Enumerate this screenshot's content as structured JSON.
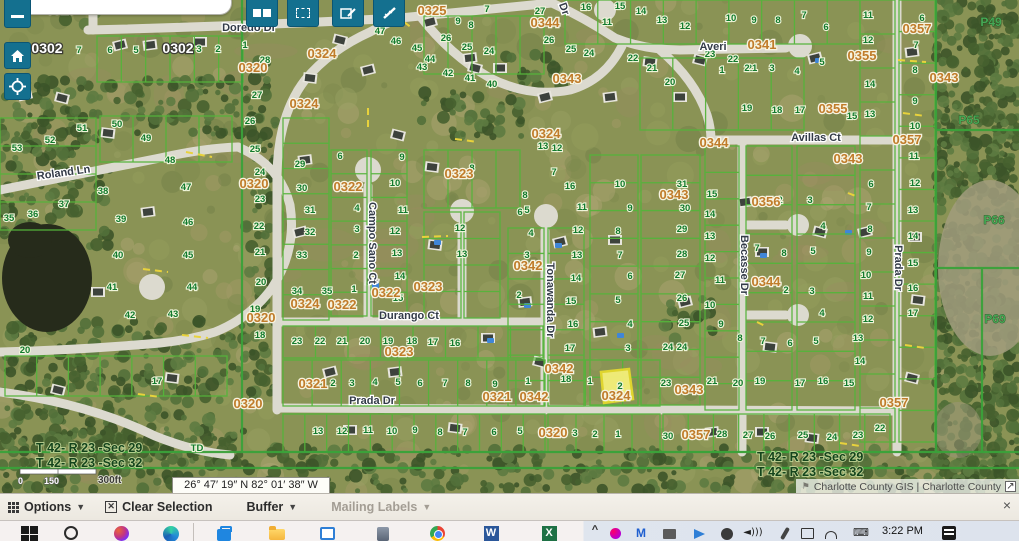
{
  "app": {
    "coordinates": "26° 47′ 19″ N 82° 01′ 38″ W",
    "attribution": "Charlotte County GIS | Charlotte County"
  },
  "toolbar": {
    "buttons": [
      {
        "name": "layers-button"
      },
      {
        "name": "select-rectangle-button"
      },
      {
        "name": "edit-button"
      },
      {
        "name": "measure-button"
      }
    ],
    "left_controls": [
      {
        "name": "zoom-out-button"
      },
      {
        "name": "home-button"
      },
      {
        "name": "locate-button"
      }
    ]
  },
  "options_bar": {
    "items": [
      {
        "name": "options-menu",
        "label": "Options"
      },
      {
        "name": "clear-selection-button",
        "label": "Clear Selection"
      },
      {
        "name": "buffer-menu",
        "label": "Buffer"
      },
      {
        "name": "mailing-labels-menu",
        "label": "Mailing Labels",
        "disabled": true
      }
    ],
    "close_label": "×"
  },
  "taskbar": {
    "time": "3:22 PM",
    "icons": [
      "windows",
      "search",
      "copilot",
      "edge",
      "store",
      "file-explorer",
      "app-window",
      "app-tool",
      "chrome",
      "word",
      "excel",
      "tray-expand",
      "tray-copilot",
      "tray-mail",
      "tray-printer",
      "tray-share",
      "tray-audio",
      "tray-speaker",
      "tray-pen",
      "tray-book",
      "tray-network",
      "tray-keyboard",
      "news"
    ]
  },
  "map": {
    "scale_bar": {
      "tick0": "0",
      "tick1": "150",
      "label": "300ft"
    },
    "misc_labels": [
      [
        "TD",
        197,
        451
      ]
    ],
    "section_labels": [
      {
        "x": 36,
        "y": 452,
        "lines": [
          "T 42- R 23 -Sec 29",
          "T 42- R 23 -Sec 32"
        ]
      },
      {
        "x": 757,
        "y": 461,
        "lines": [
          "T 42- R 23 -Sec 29",
          "T 42- R 23 -Sec 32"
        ]
      }
    ],
    "streets": [
      [
        "Doredo Dr",
        249,
        31,
        0
      ],
      [
        "Roland Ln",
        64,
        176,
        -8
      ],
      [
        "Campo Sano Ct",
        369,
        243,
        90
      ],
      [
        "Durango Ct",
        409,
        319,
        0
      ],
      [
        "Tonawanda Dr",
        547,
        300,
        90
      ],
      [
        "Prada Dr",
        372,
        404,
        0
      ],
      [
        "Prada Dr",
        895,
        268,
        90
      ],
      [
        "Becasse Dr",
        741,
        265,
        90
      ],
      [
        "Averi",
        713,
        50,
        0
      ],
      [
        "Avillas Ct",
        816,
        141,
        0
      ],
      [
        "Dr",
        561,
        10,
        70
      ]
    ],
    "block_labels": [
      [
        "0319",
        61,
        14
      ],
      [
        "0320",
        253,
        72
      ],
      [
        "0320",
        254,
        188
      ],
      [
        "0320",
        261,
        322
      ],
      [
        "0320",
        248,
        408
      ],
      [
        "0320",
        553,
        437
      ],
      [
        "0321",
        313,
        388
      ],
      [
        "0321",
        497,
        401
      ],
      [
        "0322",
        348,
        191
      ],
      [
        "0322",
        386,
        297
      ],
      [
        "0322",
        342,
        309
      ],
      [
        "0323",
        459,
        178
      ],
      [
        "0323",
        428,
        291
      ],
      [
        "0323",
        399,
        356
      ],
      [
        "0324",
        322,
        58
      ],
      [
        "0324",
        304,
        108
      ],
      [
        "0324",
        546,
        138
      ],
      [
        "0324",
        305,
        308
      ],
      [
        "0324",
        616,
        400
      ],
      [
        "0325",
        432,
        15
      ],
      [
        "0341",
        762,
        49
      ],
      [
        "0342",
        528,
        270
      ],
      [
        "0342",
        559,
        373
      ],
      [
        "0342",
        534,
        401
      ],
      [
        "0343",
        567,
        83
      ],
      [
        "0343",
        674,
        199
      ],
      [
        "0343",
        944,
        82
      ],
      [
        "0343",
        848,
        163
      ],
      [
        "0343",
        689,
        394
      ],
      [
        "0344",
        545,
        27
      ],
      [
        "0344",
        714,
        147
      ],
      [
        "0344",
        766,
        286
      ],
      [
        "0355",
        862,
        60
      ],
      [
        "0355",
        833,
        113
      ],
      [
        "0356",
        766,
        206
      ],
      [
        "0357",
        917,
        33
      ],
      [
        "0357",
        907,
        144
      ],
      [
        "0357",
        696,
        439
      ],
      [
        "0357",
        894,
        407
      ]
    ],
    "white_labels": [
      [
        "0302",
        47,
        53
      ],
      [
        "0302",
        178,
        53
      ]
    ],
    "plat_labels": [
      [
        "P49",
        991,
        26
      ],
      [
        "P65",
        969,
        124
      ],
      [
        "P66",
        994,
        224
      ],
      [
        "P69",
        995,
        323
      ]
    ],
    "selected_parcel": {
      "lot": "2",
      "x": 601,
      "y": 369,
      "w": 32,
      "h": 34
    },
    "lots": [
      [
        "53",
        17,
        151
      ],
      [
        "52",
        50,
        143
      ],
      [
        "51",
        82,
        131
      ],
      [
        "50",
        117,
        127
      ],
      [
        "49",
        146,
        141
      ],
      [
        "48",
        170,
        163
      ],
      [
        "47",
        186,
        190
      ],
      [
        "38",
        103,
        194
      ],
      [
        "37",
        64,
        207
      ],
      [
        "36",
        33,
        217
      ],
      [
        "35",
        9,
        221
      ],
      [
        "39",
        121,
        222
      ],
      [
        "46",
        188,
        225
      ],
      [
        "40",
        118,
        258
      ],
      [
        "45",
        188,
        258
      ],
      [
        "41",
        112,
        290
      ],
      [
        "44",
        192,
        290
      ],
      [
        "42",
        130,
        318
      ],
      [
        "43",
        173,
        317
      ],
      [
        "26",
        250,
        124
      ],
      [
        "25",
        255,
        152
      ],
      [
        "24",
        260,
        175
      ],
      [
        "23",
        260,
        202
      ],
      [
        "22",
        259,
        229
      ],
      [
        "21",
        260,
        255
      ],
      [
        "20",
        261,
        285
      ],
      [
        "19",
        255,
        312
      ],
      [
        "18",
        260,
        338
      ],
      [
        "20",
        25,
        353
      ],
      [
        "17",
        157,
        384
      ],
      [
        "7",
        79,
        53
      ],
      [
        "6",
        110,
        53
      ],
      [
        "5",
        136,
        53
      ],
      [
        "3",
        199,
        52
      ],
      [
        "2",
        218,
        52
      ],
      [
        "1",
        245,
        48
      ],
      [
        "28",
        265,
        63
      ],
      [
        "27",
        257,
        98
      ],
      [
        "47",
        380,
        34
      ],
      [
        "46",
        396,
        44
      ],
      [
        "45",
        417,
        51
      ],
      [
        "44",
        430,
        62
      ],
      [
        "43",
        422,
        70
      ],
      [
        "42",
        448,
        76
      ],
      [
        "41",
        470,
        81
      ],
      [
        "40",
        492,
        87
      ],
      [
        "9",
        458,
        24
      ],
      [
        "8",
        471,
        28
      ],
      [
        "7",
        487,
        12
      ],
      [
        "27",
        540,
        14
      ],
      [
        "26",
        446,
        41
      ],
      [
        "25",
        467,
        50
      ],
      [
        "24",
        489,
        54
      ],
      [
        "22",
        633,
        61
      ],
      [
        "21",
        652,
        71
      ],
      [
        "20",
        670,
        85
      ],
      [
        "26",
        549,
        43
      ],
      [
        "25",
        571,
        52
      ],
      [
        "24",
        589,
        56
      ],
      [
        "23",
        710,
        57
      ],
      [
        "22",
        733,
        62
      ],
      [
        "21",
        752,
        71
      ],
      [
        "16",
        586,
        10
      ],
      [
        "15",
        620,
        9
      ],
      [
        "14",
        641,
        14
      ],
      [
        "13",
        662,
        23
      ],
      [
        "12",
        685,
        29
      ],
      [
        "11",
        607,
        25
      ],
      [
        "10",
        731,
        21
      ],
      [
        "9",
        754,
        23
      ],
      [
        "8",
        778,
        23
      ],
      [
        "7",
        804,
        18
      ],
      [
        "6",
        826,
        30
      ],
      [
        "1",
        722,
        73
      ],
      [
        "2",
        747,
        71
      ],
      [
        "3",
        772,
        71
      ],
      [
        "4",
        797,
        74
      ],
      [
        "5",
        822,
        65
      ],
      [
        "19",
        747,
        111
      ],
      [
        "18",
        777,
        113
      ],
      [
        "17",
        800,
        113
      ],
      [
        "15",
        852,
        119
      ],
      [
        "13",
        543,
        149
      ],
      [
        "12",
        557,
        151
      ],
      [
        "29",
        300,
        167
      ],
      [
        "30",
        302,
        191
      ],
      [
        "31",
        310,
        213
      ],
      [
        "32",
        310,
        235
      ],
      [
        "33",
        302,
        258
      ],
      [
        "34",
        297,
        294
      ],
      [
        "35",
        327,
        294
      ],
      [
        "6",
        340,
        159
      ],
      [
        "4",
        357,
        211
      ],
      [
        "3",
        357,
        232
      ],
      [
        "2",
        356,
        258
      ],
      [
        "1",
        354,
        292
      ],
      [
        "9",
        402,
        160
      ],
      [
        "10",
        395,
        186
      ],
      [
        "11",
        403,
        213
      ],
      [
        "12",
        395,
        234
      ],
      [
        "13",
        397,
        256
      ],
      [
        "14",
        400,
        279
      ],
      [
        "15",
        398,
        301
      ],
      [
        "8",
        472,
        171
      ],
      [
        "7",
        554,
        175
      ],
      [
        "12",
        460,
        231
      ],
      [
        "13",
        462,
        257
      ],
      [
        "5",
        527,
        213
      ],
      [
        "4",
        531,
        236
      ],
      [
        "3",
        527,
        258
      ],
      [
        "2",
        519,
        298
      ],
      [
        "8",
        525,
        198
      ],
      [
        "6",
        520,
        215
      ],
      [
        "16",
        570,
        189
      ],
      [
        "10",
        620,
        187
      ],
      [
        "11",
        582,
        210
      ],
      [
        "12",
        578,
        233
      ],
      [
        "13",
        577,
        258
      ],
      [
        "14",
        576,
        281
      ],
      [
        "15",
        571,
        304
      ],
      [
        "16",
        573,
        327
      ],
      [
        "17",
        570,
        351
      ],
      [
        "9",
        630,
        211
      ],
      [
        "8",
        618,
        234
      ],
      [
        "7",
        620,
        258
      ],
      [
        "6",
        630,
        279
      ],
      [
        "5",
        618,
        303
      ],
      [
        "4",
        630,
        327
      ],
      [
        "3",
        628,
        351
      ],
      [
        "31",
        682,
        187
      ],
      [
        "30",
        685,
        211
      ],
      [
        "29",
        682,
        232
      ],
      [
        "28",
        682,
        257
      ],
      [
        "27",
        680,
        278
      ],
      [
        "26",
        682,
        301
      ],
      [
        "25",
        684,
        326
      ],
      [
        "24",
        682,
        350
      ],
      [
        "15",
        712,
        197
      ],
      [
        "14",
        710,
        217
      ],
      [
        "13",
        710,
        239
      ],
      [
        "12",
        710,
        261
      ],
      [
        "11",
        720,
        283
      ],
      [
        "10",
        710,
        308
      ],
      [
        "9",
        721,
        327
      ],
      [
        "8",
        740,
        341
      ],
      [
        "7",
        763,
        344
      ],
      [
        "6",
        790,
        346
      ],
      [
        "2",
        780,
        203
      ],
      [
        "3",
        810,
        203
      ],
      [
        "4",
        823,
        229
      ],
      [
        "5",
        813,
        254
      ],
      [
        "7",
        757,
        251
      ],
      [
        "8",
        784,
        256
      ],
      [
        "2",
        786,
        293
      ],
      [
        "3",
        812,
        294
      ],
      [
        "4",
        822,
        316
      ],
      [
        "5",
        816,
        344
      ],
      [
        "21",
        712,
        384
      ],
      [
        "20",
        738,
        386
      ],
      [
        "19",
        760,
        384
      ],
      [
        "17",
        800,
        386
      ],
      [
        "16",
        823,
        384
      ],
      [
        "15",
        849,
        386
      ],
      [
        "11",
        868,
        18
      ],
      [
        "12",
        868,
        43
      ],
      [
        "14",
        870,
        87
      ],
      [
        "13",
        870,
        117
      ],
      [
        "6",
        922,
        21
      ],
      [
        "7",
        916,
        48
      ],
      [
        "8",
        915,
        73
      ],
      [
        "9",
        915,
        104
      ],
      [
        "10",
        915,
        129
      ],
      [
        "11",
        914,
        159
      ],
      [
        "12",
        915,
        186
      ],
      [
        "13",
        913,
        213
      ],
      [
        "14",
        913,
        239
      ],
      [
        "15",
        913,
        266
      ],
      [
        "16",
        913,
        291
      ],
      [
        "17",
        913,
        316
      ],
      [
        "6",
        871,
        187
      ],
      [
        "7",
        869,
        210
      ],
      [
        "8",
        870,
        232
      ],
      [
        "9",
        869,
        255
      ],
      [
        "10",
        866,
        278
      ],
      [
        "11",
        868,
        299
      ],
      [
        "12",
        868,
        322
      ],
      [
        "13",
        858,
        341
      ],
      [
        "14",
        860,
        364
      ],
      [
        "23",
        297,
        344
      ],
      [
        "22",
        320,
        344
      ],
      [
        "21",
        342,
        344
      ],
      [
        "20",
        365,
        344
      ],
      [
        "19",
        388,
        344
      ],
      [
        "18",
        412,
        344
      ],
      [
        "17",
        433,
        345
      ],
      [
        "16",
        455,
        346
      ],
      [
        "2",
        333,
        386
      ],
      [
        "3",
        352,
        386
      ],
      [
        "4",
        375,
        385
      ],
      [
        "5",
        398,
        385
      ],
      [
        "6",
        420,
        386
      ],
      [
        "7",
        445,
        386
      ],
      [
        "8",
        468,
        386
      ],
      [
        "9",
        495,
        387
      ],
      [
        "1",
        528,
        384
      ],
      [
        "18",
        566,
        382
      ],
      [
        "1",
        590,
        384
      ],
      [
        "23",
        666,
        386
      ],
      [
        "24",
        668,
        350
      ],
      [
        "13",
        318,
        434
      ],
      [
        "12",
        342,
        434
      ],
      [
        "11",
        368,
        433
      ],
      [
        "10",
        392,
        434
      ],
      [
        "9",
        415,
        433
      ],
      [
        "8",
        440,
        435
      ],
      [
        "7",
        465,
        435
      ],
      [
        "6",
        494,
        435
      ],
      [
        "5",
        520,
        434
      ],
      [
        "3",
        575,
        436
      ],
      [
        "2",
        595,
        437
      ],
      [
        "1",
        618,
        437
      ],
      [
        "30",
        668,
        439
      ],
      [
        "28",
        722,
        437
      ],
      [
        "27",
        748,
        438
      ],
      [
        "26",
        770,
        439
      ],
      [
        "25",
        803,
        438
      ],
      [
        "24",
        832,
        440
      ],
      [
        "23",
        858,
        438
      ],
      [
        "22",
        880,
        431
      ]
    ]
  }
}
